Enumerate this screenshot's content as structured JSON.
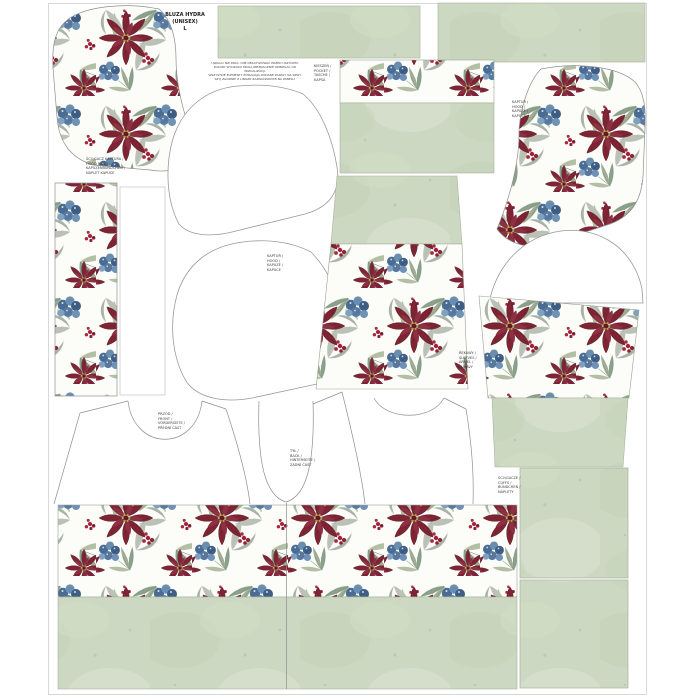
{
  "panel": {
    "title": {
      "lines": [
        "BLUZA HYDRA",
        "(UNISEX)",
        "L"
      ]
    },
    "care_text": {
      "lines": [
        "UWAGA! NIE PRAĆ I NIE DEKATYZOWAĆ PRZED USZYCIEM.",
        "KOLORY WYDRUKU MOGĄ NIEZNACZNIE ODBIEGAĆ OD WIZUALIZACJI.",
        "WSZYSTKIE ELEMENTY POSIADAJĄ DODANE ZAPASY NA SZWY.",
        "SZYJ ZGODNIE Z LINIAMI ZAZNACZONYMI NA PANELU."
      ]
    },
    "labels": {
      "hood_center": {
        "lines": [
          "KAPTUR /",
          "HOOD /",
          "KAPUZE /",
          "KAPUCE"
        ]
      },
      "hood_right": {
        "lines": [
          "KAPTUR /",
          "HOOD /",
          "KAPUZE /",
          "KAPUCE"
        ]
      },
      "hood_trim": {
        "lines": [
          "ŚCIĄGACZ KAPTURA /",
          "HOOD BAND /",
          "KAPUZENBÜNDCHEN /",
          "NÁPLET KAPUCE"
        ]
      },
      "pocket": {
        "lines": [
          "KIESZEŃ /",
          "POCKET /",
          "TASCHE /",
          "KAPSA"
        ]
      },
      "sleeves": {
        "lines": [
          "RĘKAWY /",
          "SLEEVES /",
          "ÄRMEL /",
          "RUKÁVY"
        ]
      },
      "front": {
        "lines": [
          "PRZÓD /",
          "FRONT /",
          "VORDERSEITE /",
          "PŘEDNÍ ČÁST"
        ]
      },
      "back": {
        "lines": [
          "TYŁ /",
          "BACK /",
          "HINTERSEITE /",
          "ZADNÍ ČÁST"
        ]
      },
      "cuffs": {
        "lines": [
          "ŚCIĄGACZE /",
          "CUFFS /",
          "BÜNDCHEN /",
          "NÁPLETY"
        ]
      }
    },
    "colors": {
      "sage_green": "#cdd8c2",
      "floral_red": "#7c2433",
      "floral_blue": "#5a7ca3",
      "leaf_green": "#9fae92",
      "outline_grey": "#8f8f8f",
      "background": "#ffffff"
    }
  }
}
